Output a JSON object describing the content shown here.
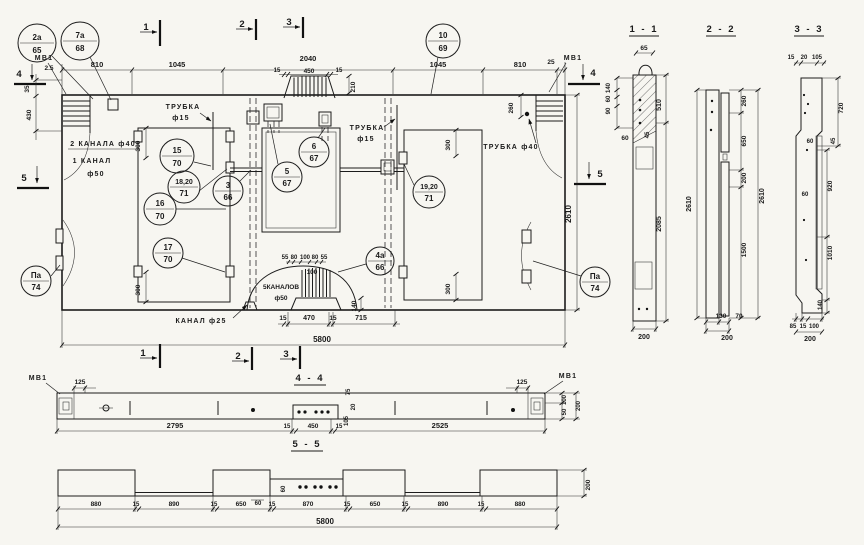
{
  "drawing": {
    "plan": {
      "markers": {
        "top": [
          "1",
          "2",
          "3"
        ],
        "bottom": [
          "1",
          "2",
          "3"
        ],
        "left_top": "4",
        "left_mid": "5",
        "right_top": "4",
        "right_mid": "5"
      },
      "anchor_left": "МВ1",
      "anchor_right": "МВ1",
      "callouts": [
        {
          "num": "2а",
          "sheet": "65"
        },
        {
          "num": "7а",
          "sheet": "68"
        },
        {
          "num": "10",
          "sheet": "69"
        },
        {
          "num": "15",
          "sheet": "70"
        },
        {
          "num": "18,20",
          "sheet": "71"
        },
        {
          "num": "3",
          "sheet": "66"
        },
        {
          "num": "16",
          "sheet": "70"
        },
        {
          "num": "17",
          "sheet": "70"
        },
        {
          "num": "6",
          "sheet": "67"
        },
        {
          "num": "5",
          "sheet": "67"
        },
        {
          "num": "19,20",
          "sheet": "71"
        },
        {
          "num": "4а",
          "sheet": "66"
        },
        {
          "num": "Па",
          "sheet": "74"
        },
        {
          "num": "Па",
          "sheet": "74"
        }
      ],
      "labels": {
        "tube15_left_1": "ТРУБКА",
        "tube15_left_2": "ф15",
        "tube15_mid_1": "ТРУБКА",
        "tube15_mid_2": "ф15",
        "tube40_right": "ТРУБКА ф40",
        "channels2": "2 КАНАЛА ф40",
        "channel1_1": "1 КАНАЛ",
        "channel1_2": "ф50",
        "channels5_1": "5КАНАЛОВ",
        "channels5_2": "ф50",
        "channel25": "КАНАЛ ф25"
      },
      "dims": {
        "top": [
          "810",
          "1045",
          "2040",
          "1045",
          "810",
          "25"
        ],
        "top_sub": [
          "15",
          "450",
          "15"
        ],
        "d210": "210",
        "left": [
          "2.5",
          "35",
          "430"
        ],
        "right_260": "260",
        "right_2610": "2610",
        "v300": [
          "300",
          "300",
          "300",
          "300"
        ],
        "hump_top": [
          "55",
          "80",
          "100",
          "80",
          "55"
        ],
        "hump_100": "100",
        "hump_140": "140",
        "bottom": [
          "15",
          "470",
          "15",
          "715"
        ],
        "total": "5800"
      }
    },
    "s11": {
      "title": "1 - 1",
      "w65": "65",
      "left": [
        "140",
        "60",
        "90"
      ],
      "d60": "60",
      "d45": "45",
      "d510": "510",
      "d2085": "2085",
      "w200": "200"
    },
    "s22": {
      "title": "2 - 2",
      "right": [
        "260",
        "650",
        "200",
        "1500"
      ],
      "h2610_l": "2610",
      "h2610_r": "2610",
      "b130": "130",
      "b70": "70",
      "w200": "200"
    },
    "s33": {
      "title": "3 - 3",
      "top": [
        "15",
        "20",
        "105"
      ],
      "d720": "720",
      "d45": "45",
      "d920": "920",
      "d1010": "1010",
      "d140": "140",
      "d60a": "60",
      "d60b": "60",
      "bottom": [
        "85",
        "15",
        "100"
      ],
      "w200": "200"
    },
    "s44": {
      "title": "4 - 4",
      "mv1_l": "МВ1",
      "mv1_r": "МВ1",
      "d125_l": "125",
      "d125_r": "125",
      "bottom": [
        "2795",
        "15",
        "450",
        "15",
        "2525"
      ],
      "recess": [
        "75",
        "20",
        "105"
      ],
      "end": [
        "100",
        "50",
        "200"
      ]
    },
    "s55": {
      "title": "5 - 5",
      "bottom": [
        "880",
        "15",
        "890",
        "15",
        "650",
        "15",
        "870",
        "15",
        "650",
        "15",
        "890",
        "15",
        "880"
      ],
      "d60v": "60",
      "d60h": "60",
      "w200": "200",
      "total": "5800"
    }
  }
}
